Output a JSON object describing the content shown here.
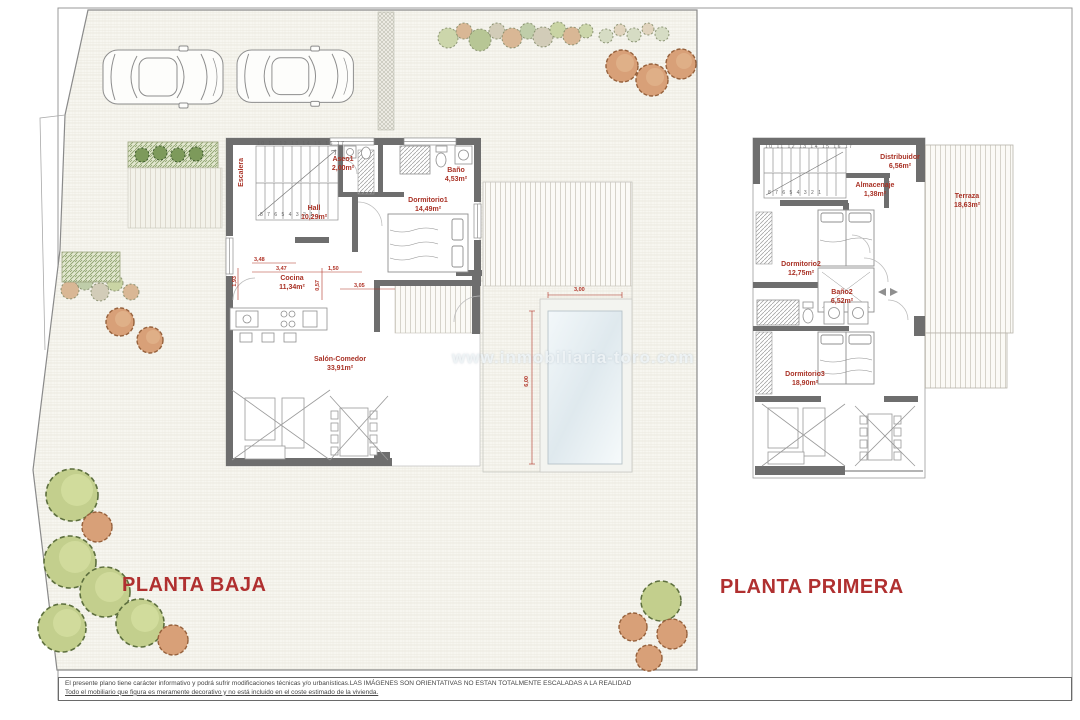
{
  "titles": {
    "ground": "PLANTA BAJA",
    "first": "PLANTA PRIMERA"
  },
  "watermark": "www.inmobiliaria-toro.com",
  "ground_floor": {
    "rooms": {
      "escalera": {
        "name": "Escalera"
      },
      "aseo": {
        "name": "Aseo1",
        "area": "2,00m²"
      },
      "bano": {
        "name": "Baño",
        "area": "4,53m²"
      },
      "hall": {
        "name": "Hall",
        "area": "10,29m²"
      },
      "dormitorio1": {
        "name": "Dormitorio1",
        "area": "14,49m²"
      },
      "cocina": {
        "name": "Cocina",
        "area": "11,34m²"
      },
      "salon": {
        "name": "Salón-Comedor",
        "area": "33,91m²"
      }
    },
    "stairs_numbers_top": "10 11 12 13 14 15 16 17",
    "stairs_numbers_bottom": "8 7 6 5 4 3 2 1",
    "dimensions": {
      "d1": "3,48",
      "d2": "3,47",
      "d3": "1,50",
      "d4": "3,05",
      "d5": "1,93",
      "d6": "0,57"
    },
    "pool": {
      "width": "3,00",
      "length": "6,00"
    }
  },
  "first_floor": {
    "rooms": {
      "distribuidor": {
        "name": "Distribuidor",
        "area": "6,56m²"
      },
      "almacenaje": {
        "name": "Almacenaje",
        "area": "1,38m²"
      },
      "dormitorio2": {
        "name": "Dormitorio2",
        "area": "12,75m²"
      },
      "bano2": {
        "name": "Baño2",
        "area": "6,52m²"
      },
      "dormitorio3": {
        "name": "Dormitorio3",
        "area": "18,90m²"
      },
      "terraza": {
        "name": "Terraza",
        "area": "18,63m²"
      }
    },
    "stairs_numbers_top": "10 11 12 13 14 15 16 17",
    "stairs_numbers_bottom": "8 7 6 5 4 3 2 1"
  },
  "footer": {
    "line1": "El presente  plano tiene carácter informativo y podrá  sufrir modificaciones técnicas y/o urbanísticas.LAS IMÁGENES SON ORIENTATIVAS NO ESTAN TOTALMENTE ESCALADAS A LA REALIDAD",
    "line2": "Todo el mobiliario que figura es meramente decorativo y no está incluido en el coste estimado de la vivienda."
  }
}
